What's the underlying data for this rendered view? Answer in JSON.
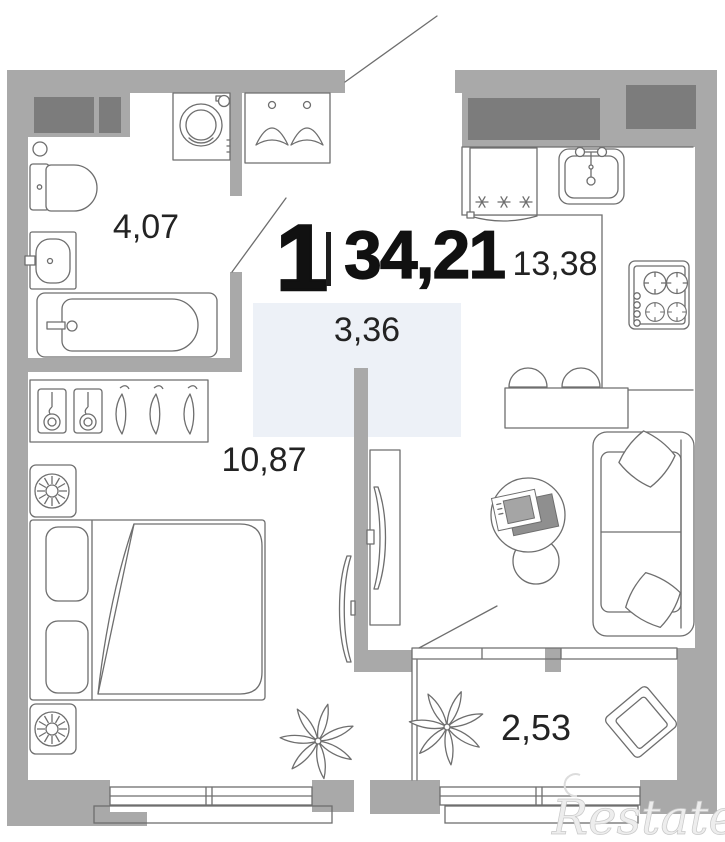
{
  "title": {
    "rooms": "1",
    "separator": "|",
    "area": "34,21"
  },
  "rooms": [
    {
      "name": "bathroom",
      "area": "4,07"
    },
    {
      "name": "hallway",
      "area": "3,36"
    },
    {
      "name": "kitchen-living-room",
      "area": "13,38"
    },
    {
      "name": "bedroom",
      "area": "10,87"
    },
    {
      "name": "balcony",
      "area": "2,53"
    }
  ],
  "watermark": {
    "text": "Restate"
  },
  "colors": {
    "wall": "#a9a9a9",
    "vent_box": "#7c7c7c",
    "furniture_line": "#6e6e6e",
    "hallway_tint": "#edf1f7",
    "label_text": "#232323",
    "title_text": "#111111",
    "watermark_text": "#ededed"
  },
  "icons": [
    "toilet-icon",
    "bathroom-sink-icon",
    "bathtub-icon",
    "washing-machine-icon",
    "coat-rack-icon",
    "wardrobe-icon",
    "double-bed-icon",
    "nightstand-icon",
    "table-lamp-icon",
    "tv-icon",
    "tv-stand-icon",
    "fridge-icon",
    "kitchen-sink-icon",
    "stove-icon",
    "bar-counter-icon",
    "bar-stool-icon",
    "sofa-icon",
    "pillow-icon",
    "coffee-table-icon",
    "plant-icon",
    "armchair-icon",
    "door-swing-icon",
    "window-icon",
    "vent-shaft-icon"
  ]
}
